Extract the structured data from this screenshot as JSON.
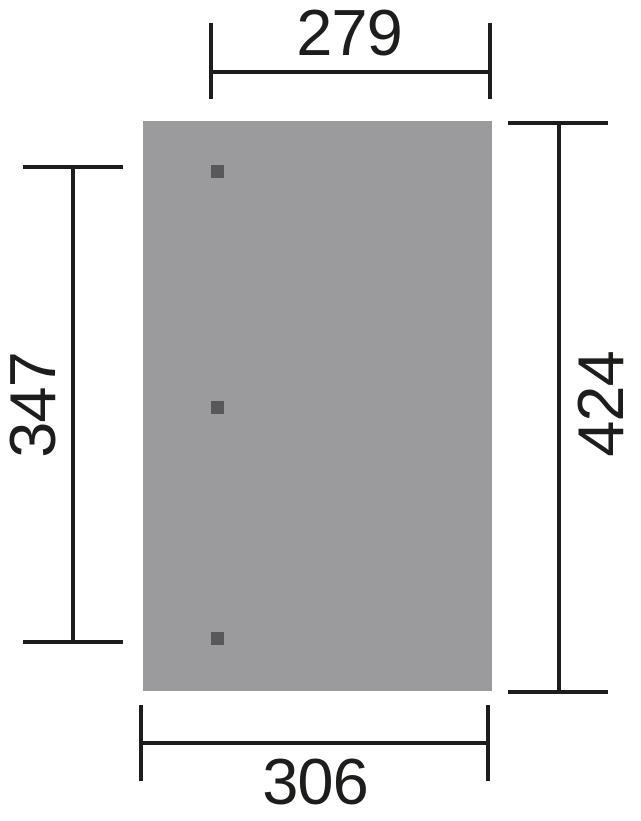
{
  "colors": {
    "background": "#ffffff",
    "line": "#1d1d1b",
    "text": "#1d1d1b",
    "panel-fill": "#9b9b9d",
    "post-fill": "#58585a"
  },
  "dimensions": {
    "top": "279",
    "bottom": "306",
    "left": "347",
    "right": "424"
  },
  "posts": {
    "count": 3
  }
}
